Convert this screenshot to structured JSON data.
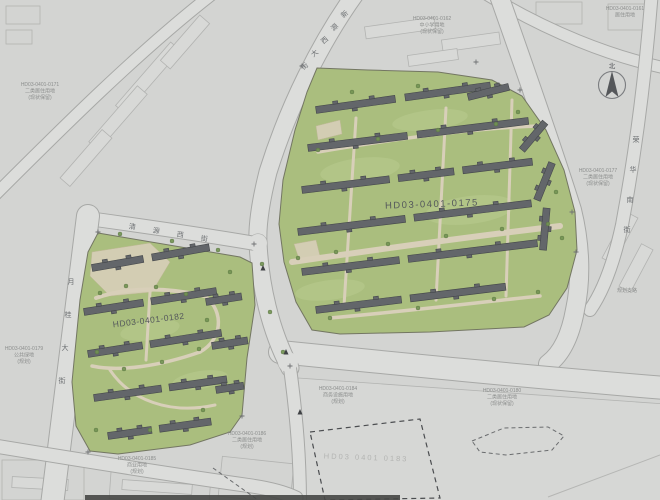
{
  "map": {
    "type": "urban-planning-site-plan",
    "parcel_labels": [
      {
        "code": "HD03-0401-0175",
        "x": 432,
        "y": 207,
        "rotate": -2,
        "size": 9.5,
        "spacing": 1.5,
        "color": "#54585d"
      },
      {
        "code": "HD03-0401-0182",
        "x": 149,
        "y": 323,
        "rotate": -7,
        "size": 8.5,
        "spacing": 0.5,
        "color": "#54585d"
      },
      {
        "code": "HD03 0401 0183",
        "x": 366,
        "y": 460,
        "rotate": 2,
        "size": 7.5,
        "spacing": 2,
        "color": "#b3b4b2"
      }
    ],
    "street_labels": [
      {
        "name": "north-arterial-street",
        "text": "新源西大街",
        "x": 346,
        "y": 16,
        "dx": -10,
        "dy": 13,
        "rotate": -40,
        "size": 7,
        "color": "#6d7073"
      },
      {
        "name": "west-street",
        "text": "清源西街",
        "x": 132,
        "y": 229,
        "dx": 24,
        "dy": 4,
        "rotate": 8,
        "size": 7,
        "color": "#6d7073"
      },
      {
        "name": "left-road",
        "text": "月桂大街",
        "x": 71,
        "y": 284,
        "dx": -3,
        "dy": 33,
        "rotate": 0,
        "size": 7,
        "color": "#6d7073"
      },
      {
        "name": "east-road",
        "text": "荣华南街",
        "x": 636,
        "y": 142,
        "dx": -3,
        "dy": 30,
        "rotate": 0,
        "size": 7,
        "color": "#6d7073"
      }
    ],
    "annotations": [
      {
        "x": 40,
        "y": 86,
        "lines": [
          "HD03-0401-0171",
          "二类居住用地",
          "(现状保留)"
        ]
      },
      {
        "x": 432,
        "y": 20,
        "lines": [
          "HD03-0401-0162",
          "中小学用地",
          "(现状保留)"
        ]
      },
      {
        "x": 598,
        "y": 172,
        "lines": [
          "HD03-0401-0177",
          "二类居住用地",
          "(现状保留)"
        ]
      },
      {
        "x": 24,
        "y": 350,
        "lines": [
          "HD03-0401-0179",
          "公共绿地",
          "(规划)"
        ]
      },
      {
        "x": 137,
        "y": 460,
        "lines": [
          "HD03-0401-0185",
          "商业用地",
          "(规划)"
        ]
      },
      {
        "x": 247,
        "y": 435,
        "lines": [
          "HD03-0401-0186",
          "二类居住用地",
          "(规划)"
        ]
      },
      {
        "x": 338,
        "y": 390,
        "lines": [
          "HD03-0401-0184",
          "商务设施用地",
          "(规划)"
        ]
      },
      {
        "x": 502,
        "y": 392,
        "lines": [
          "HD03-0401-0180",
          "二类居住用地",
          "(现状保留)"
        ]
      },
      {
        "x": 625,
        "y": 10,
        "lines": [
          "HD03-0401-0161",
          "居住用地"
        ]
      },
      {
        "x": 627,
        "y": 292,
        "lines": [
          "规划支路"
        ]
      }
    ],
    "compass": {
      "label": "北"
    },
    "colors": {
      "paper": "#d3d4d2",
      "road": "#dcdddb",
      "road_edge": "#a7a8a6",
      "green": "#a8c074",
      "green_light": "#b7cc86",
      "path": "#d9cfb5",
      "building": "#63666b",
      "building_edge": "#45484c",
      "block_outline": "#b2b3b1",
      "label": "#54585d",
      "faint": "#8b8d8c"
    }
  }
}
